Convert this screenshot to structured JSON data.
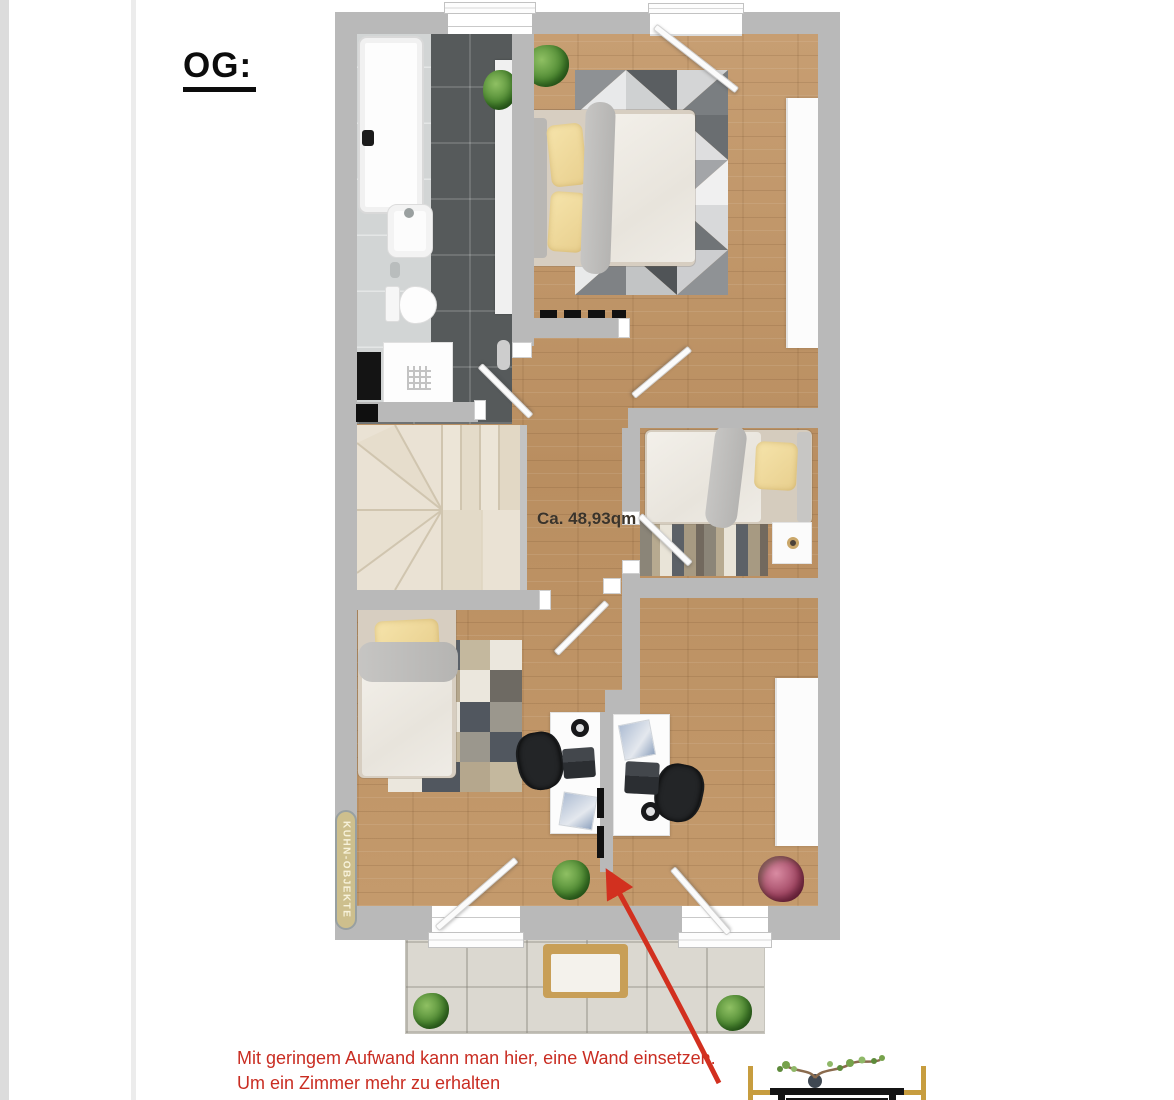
{
  "floor_title": "OG:",
  "plan": {
    "area_label": "Ca. 48,93qm",
    "watermark_badge": "KUHN-OBJEKTE"
  },
  "annotation": {
    "line1": "Mit geringem Aufwand kann man hier, eine Wand einsetzen.",
    "line2": "Um ein Zimmer mehr zu erhalten"
  },
  "colors": {
    "annotation_red": "#c92d22",
    "wall_gray": "#b9b9b9",
    "wood_floor": "#c29a6d",
    "bathroom_tile": "#565a5b",
    "stairs_cream": "#eae2d4",
    "balcony_tile": "#dbd8d0",
    "badge_bg": "#cdbf8d",
    "pillow_yellow": "#f2dc9f"
  }
}
